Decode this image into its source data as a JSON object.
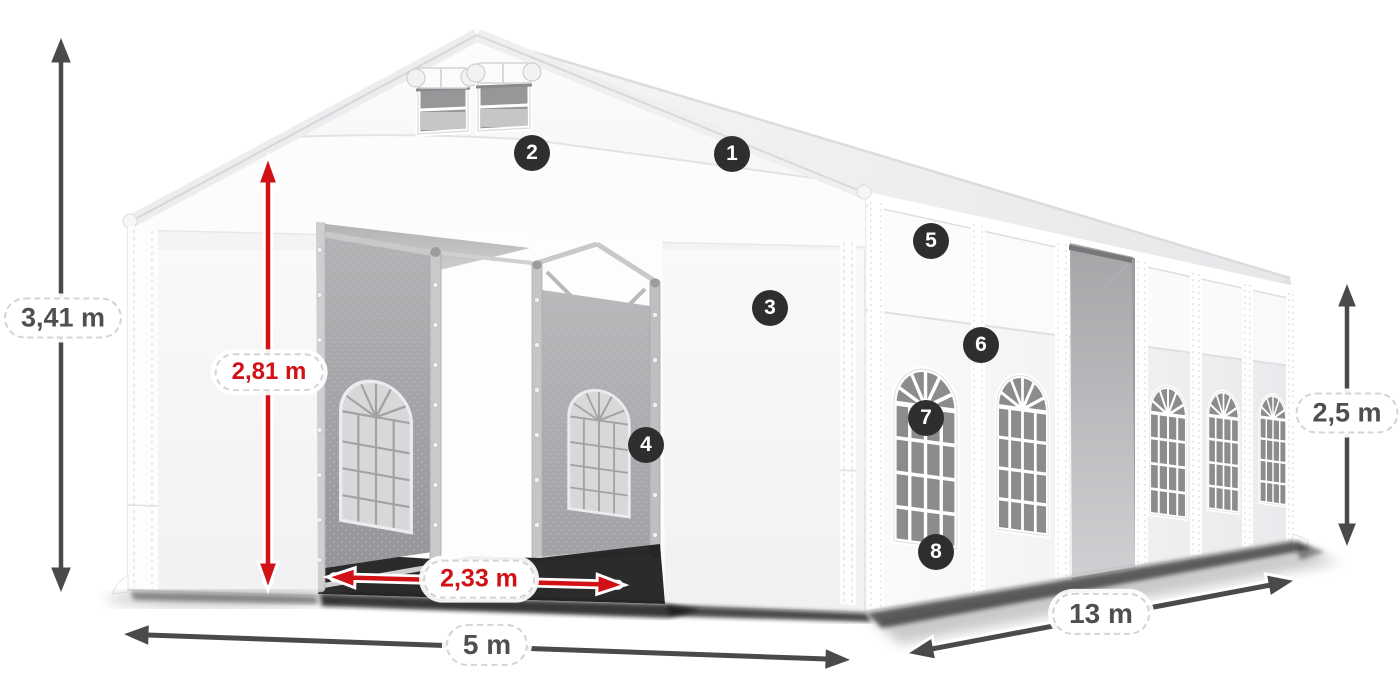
{
  "diagram": {
    "subject": "white marquee party tent with entrance doors, side windows and dimension annotations",
    "colors": {
      "accent_red": "#d01116",
      "dimension_gray": "#4f4f52",
      "badge_background": "#2e2e30",
      "tent_white": "#ffffff"
    },
    "dimensions": {
      "total_height": "3,41 m",
      "entrance_height": "2,81 m",
      "entrance_width": "2,33 m",
      "front_width": "5 m",
      "side_length": "13 m",
      "wall_height": "2,5 m"
    },
    "callouts": [
      {
        "number": "1"
      },
      {
        "number": "2"
      },
      {
        "number": "3"
      },
      {
        "number": "4"
      },
      {
        "number": "5"
      },
      {
        "number": "6"
      },
      {
        "number": "7"
      },
      {
        "number": "8"
      }
    ]
  }
}
